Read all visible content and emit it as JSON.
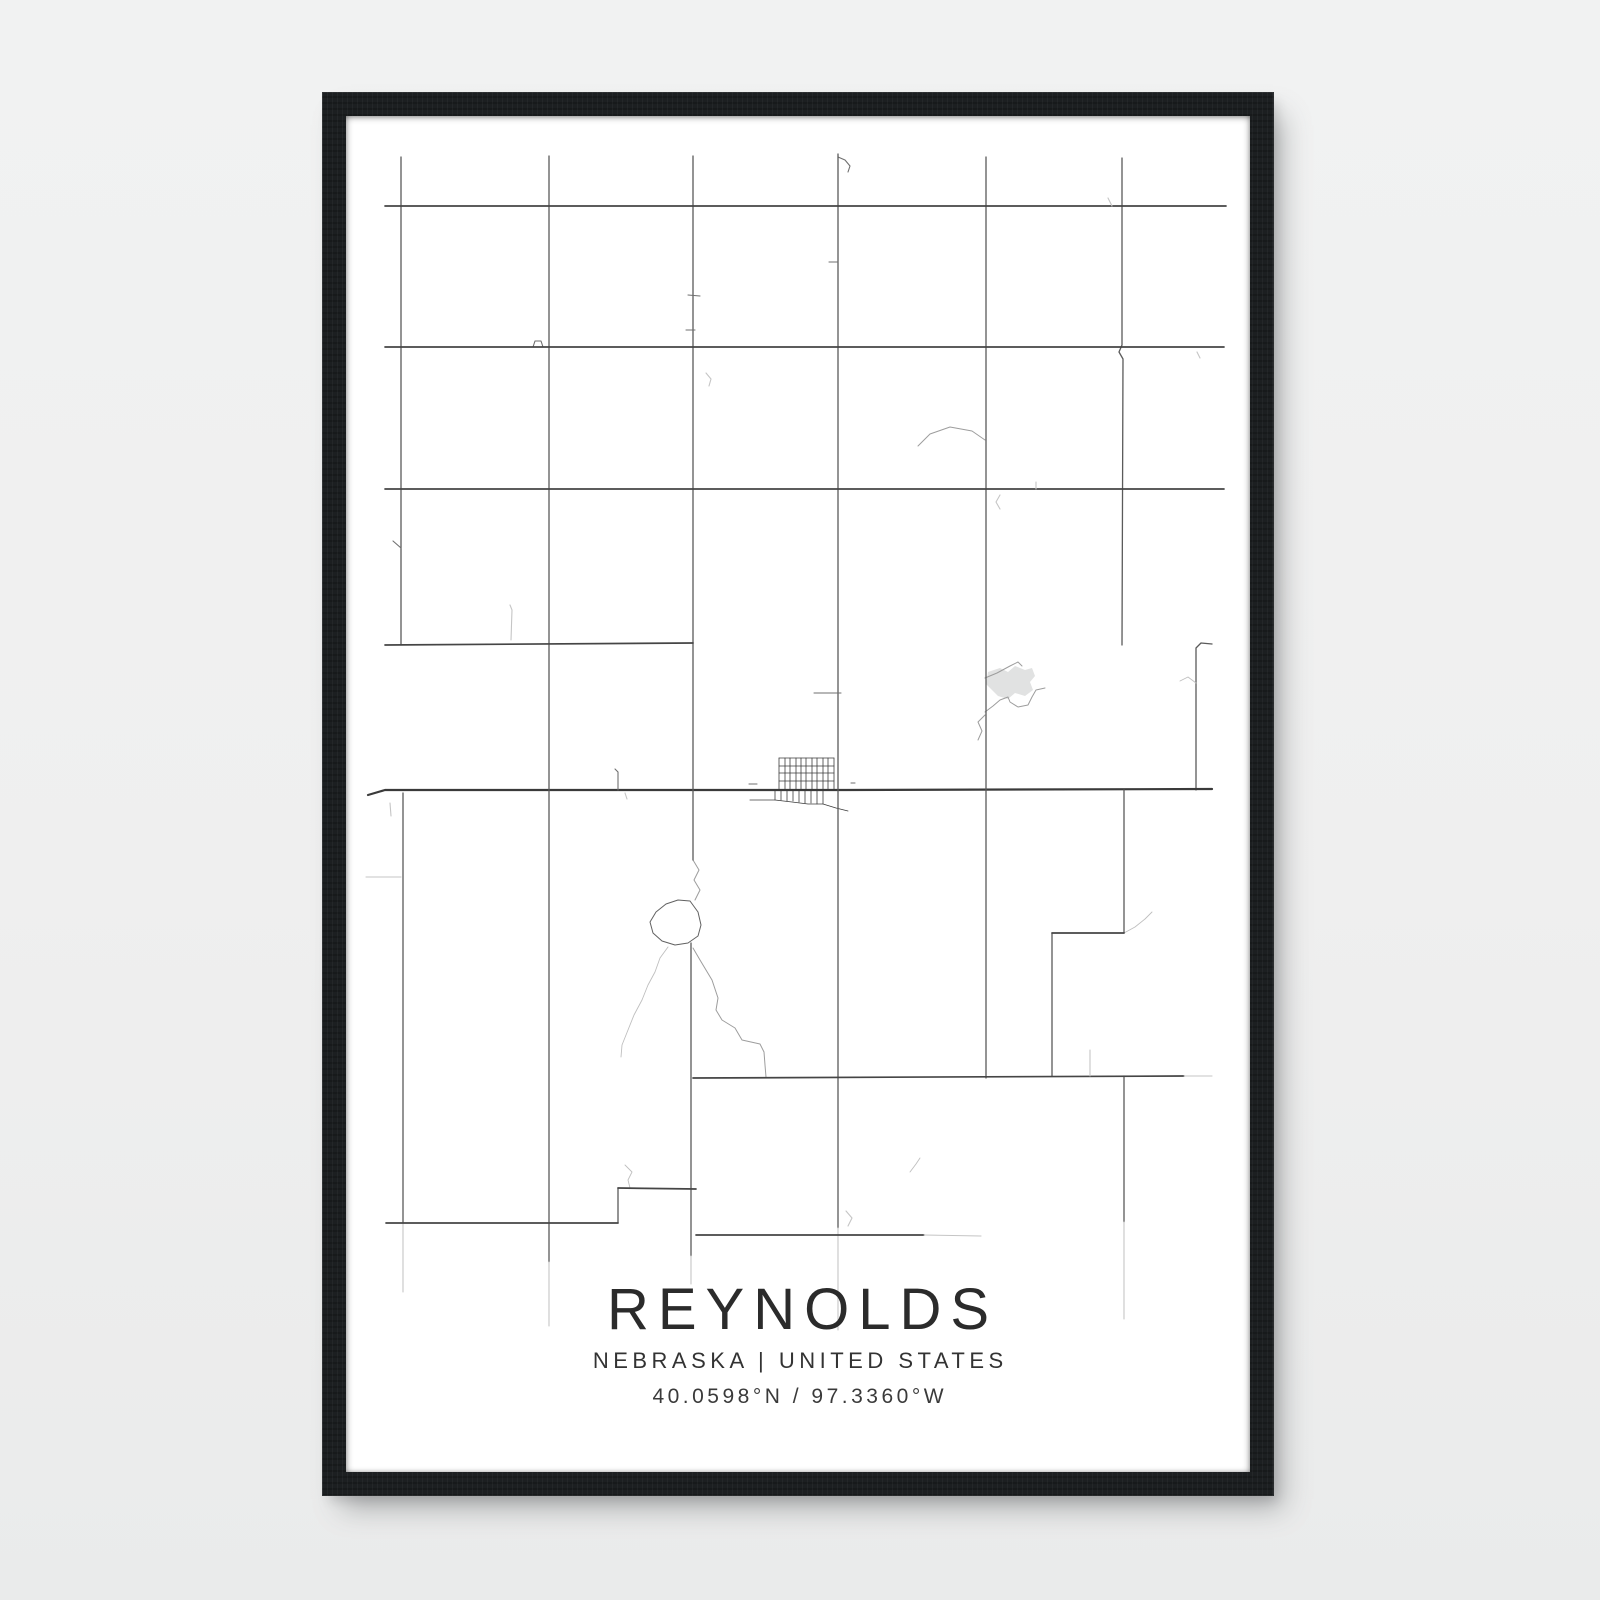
{
  "poster": {
    "title": "REYNOLDS",
    "subtitle": "NEBRASKA | UNITED STATES",
    "coordinates": "40.0598°N / 97.3360°W",
    "place": "Reynolds",
    "region": "Nebraska",
    "country": "United States",
    "latitude": "40.0598°N",
    "longitude": "97.3360°W"
  },
  "colors": {
    "background": "#f0f1f1",
    "frame": "#1c1f21",
    "poster": "#ffffff",
    "road_major": "#3a3a3a",
    "road_minor": "#5a5a5a",
    "creek": "#9d9d9d",
    "pond": "#e1e2e2",
    "title_text": "#2b2b2b"
  },
  "map": {
    "viewbox": "0 0 904 1356",
    "segments": [
      [
        55,
        41,
        55,
        529,
        "rd-v"
      ],
      [
        57,
        677,
        57,
        1107,
        "rd-v"
      ],
      [
        57,
        1107,
        57,
        1176,
        "rd-fade"
      ],
      [
        203,
        40,
        203,
        1146,
        "rd-v"
      ],
      [
        203,
        1146,
        203,
        1210,
        "rd-fade"
      ],
      [
        347,
        40,
        347,
        744,
        "rd-v"
      ],
      [
        345,
        827,
        345,
        1140,
        "rd-v"
      ],
      [
        345,
        1140,
        345,
        1168,
        "rd-fade"
      ],
      [
        492,
        38,
        492,
        1112,
        "rd-v"
      ],
      [
        492,
        1112,
        492,
        1214,
        "rd-fade"
      ],
      [
        640,
        41,
        640,
        962,
        "rd-v"
      ],
      [
        778,
        674,
        778,
        817,
        "rd-v"
      ],
      [
        706,
        817,
        706,
        960,
        "rd-v"
      ],
      [
        778,
        960,
        778,
        1106,
        "rd-v"
      ],
      [
        778,
        1106,
        778,
        1203,
        "rd-fade"
      ],
      [
        272,
        1072,
        272,
        1107,
        "rd-v"
      ],
      [
        39,
        90,
        880,
        90,
        "rd-h"
      ],
      [
        39,
        231,
        878,
        231,
        "rd-h"
      ],
      [
        39,
        373,
        878,
        373,
        "rd-h"
      ],
      [
        39,
        529,
        347,
        527,
        "rd-h"
      ],
      [
        706,
        817,
        778,
        817,
        "rd-h"
      ],
      [
        347,
        962,
        838,
        960,
        "rd-h"
      ],
      [
        838,
        960,
        866,
        960,
        "rd-fade"
      ],
      [
        272,
        1072,
        350,
        1073,
        "rd-h"
      ],
      [
        40,
        1107,
        272,
        1107,
        "rd-h"
      ],
      [
        350,
        1119,
        578,
        1119,
        "rd-h"
      ],
      [
        578,
        1119,
        635,
        1120,
        "rd-fade"
      ],
      [
        468,
        577,
        495,
        577,
        "rd-thin"
      ],
      [
        483,
        146,
        492,
        146,
        "rd-thin"
      ],
      [
        340,
        214,
        349,
        214,
        "rd-thin"
      ],
      [
        342,
        179,
        354,
        180,
        "rd-thin"
      ],
      [
        44,
        687,
        45,
        700,
        "rd-fade"
      ],
      [
        20,
        761,
        55,
        761,
        "rd-fade"
      ],
      [
        744,
        934,
        744,
        960,
        "rd-fade"
      ],
      [
        851,
        236,
        854,
        242,
        "rd-fade"
      ],
      [
        762,
        82,
        766,
        90,
        "rd-fade"
      ],
      [
        690,
        366,
        690,
        373,
        "rd-fade"
      ],
      [
        47,
        425,
        55,
        432,
        "rd-thin"
      ],
      [
        403,
        668,
        411,
        668,
        "rd-thin"
      ],
      [
        505,
        667,
        509,
        667,
        "rd-thin"
      ],
      [
        279,
        677,
        281,
        683,
        "rd-fade"
      ],
      [
        404,
        684,
        429,
        684,
        "rd-thin"
      ],
      [
        433,
        642,
        488,
        642,
        "town"
      ],
      [
        433,
        650,
        488,
        650,
        "town"
      ],
      [
        433,
        657,
        488,
        657,
        "town"
      ],
      [
        433,
        665,
        488,
        665,
        "town"
      ],
      [
        433,
        642,
        433,
        674,
        "town"
      ],
      [
        439,
        642,
        439,
        674,
        "town"
      ],
      [
        444,
        642,
        444,
        674,
        "town"
      ],
      [
        450,
        642,
        450,
        674,
        "town"
      ],
      [
        455,
        642,
        455,
        674,
        "town"
      ],
      [
        460,
        642,
        460,
        674,
        "town"
      ],
      [
        466,
        642,
        466,
        674,
        "town"
      ],
      [
        471,
        642,
        471,
        674,
        "town"
      ],
      [
        477,
        642,
        477,
        674,
        "town"
      ],
      [
        482,
        642,
        482,
        674,
        "town"
      ],
      [
        488,
        642,
        488,
        674,
        "town"
      ],
      [
        429,
        674,
        429,
        684,
        "town"
      ],
      [
        435,
        674,
        435,
        684,
        "town"
      ],
      [
        441,
        674,
        441,
        685,
        "town"
      ],
      [
        447,
        674,
        447,
        685,
        "town"
      ],
      [
        453,
        674,
        453,
        686,
        "town"
      ],
      [
        459,
        674,
        459,
        687,
        "town"
      ],
      [
        465,
        674,
        465,
        687,
        "town"
      ],
      [
        471,
        674,
        471,
        688,
        "town"
      ],
      [
        477,
        674,
        477,
        688,
        "town"
      ]
    ],
    "polylines": [
      {
        "cls": "rd-v",
        "pts": [
          [
            776,
            42
          ],
          [
            776,
            229
          ],
          [
            773,
            236
          ],
          [
            777,
            243
          ],
          [
            776,
            529
          ]
        ]
      },
      {
        "cls": "rd-v",
        "pts": [
          [
            866,
            528
          ],
          [
            855,
            527
          ],
          [
            850,
            532
          ],
          [
            850,
            674
          ]
        ]
      },
      {
        "cls": "rd-main",
        "pts": [
          [
            22,
            679
          ],
          [
            39,
            674
          ],
          [
            500,
            674
          ],
          [
            866,
            673
          ]
        ]
      },
      {
        "cls": "rd-fade",
        "pts": [
          [
            164,
            489
          ],
          [
            166,
            494
          ],
          [
            165,
            524
          ]
        ]
      },
      {
        "cls": "rd-thin",
        "pts": [
          [
            269,
            653
          ],
          [
            272,
            656
          ],
          [
            272,
            674
          ]
        ]
      },
      {
        "cls": "rd-thin",
        "pts": [
          [
            492,
            41
          ],
          [
            499,
            44
          ],
          [
            504,
            50
          ],
          [
            502,
            56
          ]
        ]
      },
      {
        "cls": "rd-thin",
        "pts": [
          [
            187,
            231
          ],
          [
            189,
            225
          ],
          [
            195,
            225
          ],
          [
            197,
            231
          ]
        ]
      },
      {
        "cls": "rd-fade",
        "pts": [
          [
            360,
            257
          ],
          [
            365,
            263
          ],
          [
            363,
            270
          ]
        ]
      },
      {
        "cls": "rd-fade",
        "pts": [
          [
            654,
            379
          ],
          [
            650,
            386
          ],
          [
            654,
            393
          ]
        ]
      },
      {
        "cls": "rd-fade",
        "pts": [
          [
            500,
            1095
          ],
          [
            506,
            1102
          ],
          [
            502,
            1110
          ]
        ]
      },
      {
        "cls": "town",
        "pts": [
          [
            429,
            684
          ],
          [
            446,
            686
          ],
          [
            462,
            688
          ],
          [
            477,
            688
          ],
          [
            490,
            692
          ],
          [
            502,
            695
          ]
        ]
      },
      {
        "cls": "creek",
        "pts": [
          [
            572,
            330
          ],
          [
            584,
            318
          ],
          [
            604,
            311
          ],
          [
            626,
            315
          ],
          [
            639,
            324
          ]
        ]
      },
      {
        "cls": "creek",
        "pts": [
          [
            639,
            562
          ],
          [
            651,
            557
          ],
          [
            664,
            550
          ],
          [
            672,
            546
          ],
          [
            676,
            550
          ]
        ]
      },
      {
        "cls": "creek",
        "pts": [
          [
            639,
            596
          ],
          [
            647,
            590
          ],
          [
            654,
            584
          ],
          [
            662,
            581
          ],
          [
            664,
            586
          ],
          [
            672,
            591
          ],
          [
            682,
            589
          ],
          [
            686,
            581
          ],
          [
            690,
            574
          ],
          [
            699,
            572
          ]
        ]
      },
      {
        "cls": "creek",
        "pts": [
          [
            639,
            599
          ],
          [
            632,
            606
          ],
          [
            636,
            615
          ],
          [
            632,
            624
          ]
        ]
      },
      {
        "cls": "creek-light",
        "pts": [
          [
            834,
            565
          ],
          [
            842,
            561
          ],
          [
            850,
            567
          ]
        ]
      },
      {
        "cls": "creek",
        "pts": [
          [
            347,
            744
          ],
          [
            353,
            754
          ],
          [
            348,
            764
          ],
          [
            354,
            774
          ],
          [
            349,
            784
          ]
        ]
      },
      {
        "cls": "pond-outline",
        "pts": [
          [
            344,
            785
          ],
          [
            332,
            784
          ],
          [
            320,
            788
          ],
          [
            310,
            796
          ],
          [
            304,
            806
          ],
          [
            307,
            817
          ],
          [
            316,
            825
          ],
          [
            329,
            829
          ],
          [
            342,
            827
          ],
          [
            352,
            820
          ],
          [
            355,
            809
          ],
          [
            352,
            796
          ],
          [
            344,
            785
          ]
        ]
      },
      {
        "cls": "creek",
        "pts": [
          [
            347,
            832
          ],
          [
            354,
            844
          ],
          [
            366,
            864
          ],
          [
            372,
            882
          ],
          [
            370,
            894
          ],
          [
            376,
            904
          ],
          [
            389,
            912
          ],
          [
            396,
            924
          ],
          [
            414,
            928
          ],
          [
            418,
            936
          ],
          [
            419,
            949
          ],
          [
            420,
            961
          ]
        ]
      },
      {
        "cls": "creek-light",
        "pts": [
          [
            322,
            831
          ],
          [
            314,
            842
          ],
          [
            309,
            856
          ],
          [
            302,
            869
          ],
          [
            296,
            884
          ],
          [
            288,
            899
          ],
          [
            282,
            914
          ],
          [
            276,
            929
          ],
          [
            275,
            941
          ]
        ]
      },
      {
        "cls": "creek-light",
        "pts": [
          [
            279,
            1049
          ],
          [
            286,
            1056
          ],
          [
            282,
            1064
          ],
          [
            284,
            1072
          ]
        ]
      },
      {
        "cls": "creek-light",
        "pts": [
          [
            564,
            1056
          ],
          [
            570,
            1048
          ],
          [
            574,
            1042
          ]
        ]
      },
      {
        "cls": "creek-light",
        "pts": [
          [
            778,
            817
          ],
          [
            789,
            811
          ],
          [
            799,
            803
          ],
          [
            806,
            796
          ]
        ]
      }
    ],
    "pond_fill": [
      [
        642,
        556
      ],
      [
        654,
        552
      ],
      [
        662,
        556
      ],
      [
        669,
        550
      ],
      [
        679,
        554
      ],
      [
        686,
        552
      ],
      [
        689,
        560
      ],
      [
        684,
        566
      ],
      [
        687,
        574
      ],
      [
        679,
        580
      ],
      [
        669,
        577
      ],
      [
        662,
        583
      ],
      [
        652,
        580
      ],
      [
        646,
        574
      ],
      [
        640,
        568
      ]
    ]
  }
}
